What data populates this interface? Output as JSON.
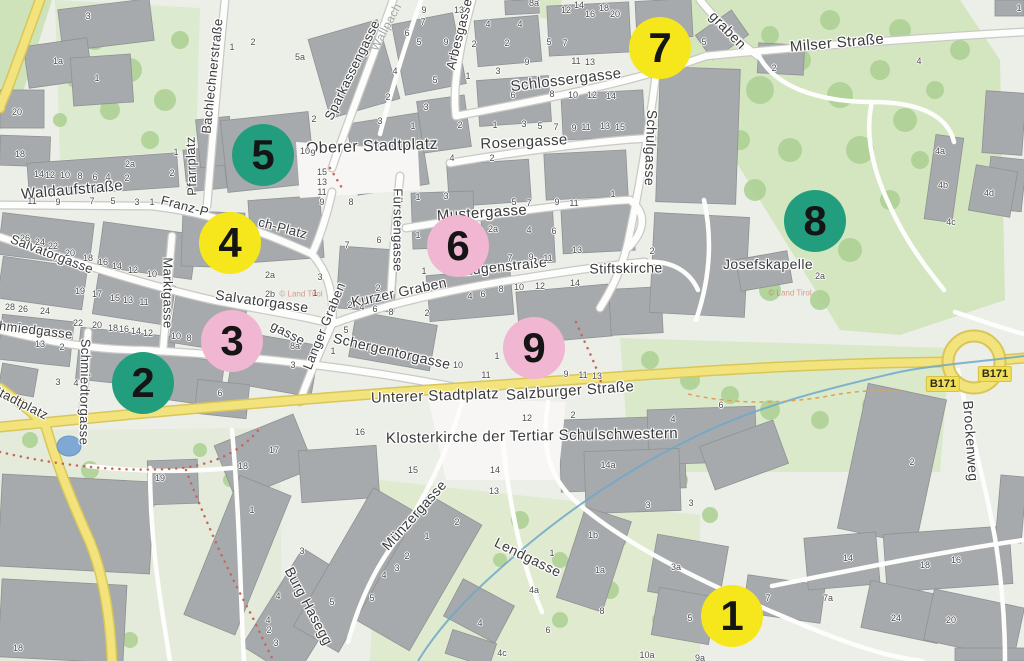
{
  "map": {
    "colors": {
      "marker_yellow": "#f6e71d",
      "marker_teal": "#229e7f",
      "marker_pink": "#f1b6d1",
      "road_yellow": "#f3e37c",
      "road_casing": "#d9c65a",
      "water": "#6fa8c9",
      "green": "#d3e6c0",
      "tree": "#aed295",
      "building": "#a7aaac"
    },
    "markers": [
      {
        "n": "1",
        "c": "yellow",
        "x": 732,
        "y": 616
      },
      {
        "n": "2",
        "c": "teal",
        "x": 143,
        "y": 383
      },
      {
        "n": "3",
        "c": "pink",
        "x": 232,
        "y": 341
      },
      {
        "n": "4",
        "c": "yellow",
        "x": 230,
        "y": 243
      },
      {
        "n": "5",
        "c": "teal",
        "x": 263,
        "y": 155
      },
      {
        "n": "6",
        "c": "pink",
        "x": 458,
        "y": 246
      },
      {
        "n": "7",
        "c": "yellow",
        "x": 660,
        "y": 48
      },
      {
        "n": "8",
        "c": "teal",
        "x": 815,
        "y": 221
      },
      {
        "n": "9",
        "c": "pink",
        "x": 534,
        "y": 348
      }
    ],
    "street_labels": [
      {
        "t": "Waldaufstraße",
        "x": 72,
        "y": 190,
        "r": -5,
        "s": 15
      },
      {
        "t": "Franz-P",
        "x": 185,
        "y": 206,
        "r": 15,
        "s": 13
      },
      {
        "t": "ch-Platz",
        "x": 283,
        "y": 228,
        "r": 15,
        "s": 13
      },
      {
        "t": "Pfarrplatz",
        "x": 191,
        "y": 166,
        "r": -92,
        "s": 13
      },
      {
        "t": "Bachlechnerstraße",
        "x": 212,
        "y": 76,
        "r": -84,
        "s": 13
      },
      {
        "t": "Sparkassengasse",
        "x": 352,
        "y": 70,
        "r": -64,
        "s": 13
      },
      {
        "t": "Wallpach",
        "x": 386,
        "y": 27,
        "r": -62,
        "s": 12,
        "c": "faint"
      },
      {
        "t": "Arbesgasse",
        "x": 459,
        "y": 34,
        "r": -76,
        "s": 13
      },
      {
        "t": "Schlossergasse",
        "x": 566,
        "y": 80,
        "r": -7,
        "s": 15
      },
      {
        "t": "Milser Straße",
        "x": 837,
        "y": 43,
        "r": -5,
        "s": 15
      },
      {
        "t": "graben",
        "x": 728,
        "y": 30,
        "r": 46,
        "s": 14
      },
      {
        "t": "Oberer Stadtplatz",
        "x": 372,
        "y": 147,
        "r": -2,
        "s": 16
      },
      {
        "t": "Rosengasse",
        "x": 524,
        "y": 142,
        "r": -3,
        "s": 15
      },
      {
        "t": "Mustergasse",
        "x": 482,
        "y": 213,
        "r": -4,
        "s": 15
      },
      {
        "t": "Fürstengasse",
        "x": 398,
        "y": 230,
        "r": 90,
        "s": 13
      },
      {
        "t": "Schulgasse",
        "x": 651,
        "y": 148,
        "r": 92,
        "s": 14
      },
      {
        "t": "Salvatorgasse",
        "x": 52,
        "y": 254,
        "r": 21,
        "s": 13
      },
      {
        "t": "Salvatorgasse",
        "x": 262,
        "y": 301,
        "r": 8,
        "s": 14
      },
      {
        "t": "gasse",
        "x": 288,
        "y": 333,
        "r": 28,
        "s": 13
      },
      {
        "t": "Schmiedgasse",
        "x": 28,
        "y": 329,
        "r": 7,
        "s": 13
      },
      {
        "t": "Stadtplatz",
        "x": 20,
        "y": 402,
        "r": 27,
        "s": 13
      },
      {
        "t": "Schmiedtorgasse",
        "x": 85,
        "y": 392,
        "r": 91,
        "s": 13
      },
      {
        "t": "Marktgasse",
        "x": 168,
        "y": 293,
        "r": 90,
        "s": 13
      },
      {
        "t": "Langer Graben",
        "x": 324,
        "y": 326,
        "r": -68,
        "s": 13
      },
      {
        "t": "Kurzer Graben",
        "x": 399,
        "y": 292,
        "r": -12,
        "s": 14
      },
      {
        "t": "Eugenstraße",
        "x": 505,
        "y": 266,
        "r": -6,
        "s": 14
      },
      {
        "t": "Stiftskirche",
        "x": 626,
        "y": 268,
        "r": -1,
        "s": 14
      },
      {
        "t": "Schergentorgasse",
        "x": 392,
        "y": 351,
        "r": 13,
        "s": 14
      },
      {
        "t": "Unterer Stadtplatz",
        "x": 435,
        "y": 396,
        "r": -2,
        "s": 15
      },
      {
        "t": "Salzburger Straße",
        "x": 570,
        "y": 391,
        "r": -4,
        "s": 15
      },
      {
        "t": "Klosterkirche der Tertiar Schulschwestern",
        "x": 532,
        "y": 436,
        "r": -1,
        "s": 15
      },
      {
        "t": "Münzergasse",
        "x": 414,
        "y": 515,
        "r": -48,
        "s": 14
      },
      {
        "t": "Lendgasse",
        "x": 528,
        "y": 557,
        "r": 26,
        "s": 14
      },
      {
        "t": "Burg Hasegg",
        "x": 309,
        "y": 606,
        "r": 62,
        "s": 14
      },
      {
        "t": "Josefskapelle",
        "x": 768,
        "y": 264,
        "r": 0,
        "s": 14
      },
      {
        "t": "Brockenweg",
        "x": 971,
        "y": 441,
        "r": 86,
        "s": 14
      }
    ],
    "route_badges": [
      {
        "t": "B171",
        "x": 943,
        "y": 384
      },
      {
        "t": "B171",
        "x": 995,
        "y": 374
      }
    ],
    "watermarks": [
      {
        "t": "© Land Tirol",
        "x": 301,
        "y": 294
      },
      {
        "t": "© Land Tirol",
        "x": 790,
        "y": 293
      }
    ],
    "house_numbers": [
      [
        88,
        16,
        "3"
      ],
      [
        58,
        61,
        "1a"
      ],
      [
        97,
        78,
        "1"
      ],
      [
        17,
        112,
        "20"
      ],
      [
        20,
        154,
        "18"
      ],
      [
        130,
        164,
        "2a"
      ],
      [
        176,
        152,
        "1"
      ],
      [
        172,
        173,
        "2"
      ],
      [
        39,
        174,
        "14"
      ],
      [
        50,
        175,
        "12"
      ],
      [
        65,
        175,
        "10"
      ],
      [
        80,
        176,
        "8"
      ],
      [
        95,
        177,
        "6"
      ],
      [
        108,
        177,
        "4"
      ],
      [
        127,
        178,
        "2"
      ],
      [
        32,
        201,
        "11"
      ],
      [
        58,
        202,
        "9"
      ],
      [
        92,
        201,
        "7"
      ],
      [
        113,
        201,
        "5"
      ],
      [
        137,
        202,
        "3"
      ],
      [
        152,
        202,
        "1"
      ],
      [
        25,
        238,
        "26"
      ],
      [
        40,
        242,
        "24"
      ],
      [
        53,
        246,
        "22"
      ],
      [
        70,
        253,
        "20"
      ],
      [
        88,
        258,
        "18"
      ],
      [
        103,
        262,
        "16"
      ],
      [
        117,
        266,
        "14"
      ],
      [
        133,
        270,
        "12"
      ],
      [
        152,
        274,
        "10"
      ],
      [
        80,
        291,
        "19"
      ],
      [
        97,
        294,
        "17"
      ],
      [
        115,
        298,
        "15"
      ],
      [
        128,
        300,
        "13"
      ],
      [
        144,
        302,
        "11"
      ],
      [
        10,
        307,
        "28"
      ],
      [
        23,
        309,
        "26"
      ],
      [
        45,
        311,
        "24"
      ],
      [
        78,
        323,
        "22"
      ],
      [
        97,
        325,
        "20"
      ],
      [
        113,
        328,
        "18"
      ],
      [
        124,
        329,
        "16"
      ],
      [
        136,
        331,
        "14"
      ],
      [
        148,
        333,
        "12"
      ],
      [
        40,
        344,
        "13"
      ],
      [
        62,
        347,
        "2"
      ],
      [
        176,
        336,
        "10"
      ],
      [
        189,
        338,
        "8"
      ],
      [
        58,
        382,
        "3"
      ],
      [
        76,
        383,
        "4"
      ],
      [
        220,
        393,
        "6"
      ],
      [
        232,
        47,
        "1"
      ],
      [
        253,
        42,
        "2"
      ],
      [
        300,
        57,
        "5a"
      ],
      [
        305,
        151,
        "10"
      ],
      [
        313,
        153,
        "9"
      ],
      [
        322,
        172,
        "15"
      ],
      [
        322,
        182,
        "13"
      ],
      [
        322,
        192,
        "11"
      ],
      [
        322,
        202,
        "9"
      ],
      [
        424,
        10,
        "9"
      ],
      [
        423,
        22,
        "7"
      ],
      [
        419,
        42,
        "5"
      ],
      [
        407,
        33,
        "6"
      ],
      [
        395,
        71,
        "4"
      ],
      [
        435,
        80,
        "5"
      ],
      [
        388,
        97,
        "2"
      ],
      [
        426,
        107,
        "3"
      ],
      [
        380,
        121,
        "3"
      ],
      [
        413,
        126,
        "1"
      ],
      [
        314,
        119,
        "2"
      ],
      [
        459,
        10,
        "13"
      ],
      [
        446,
        42,
        "9"
      ],
      [
        474,
        44,
        "2"
      ],
      [
        488,
        24,
        "4"
      ],
      [
        507,
        43,
        "2"
      ],
      [
        520,
        24,
        "4"
      ],
      [
        468,
        76,
        "1"
      ],
      [
        498,
        71,
        "3"
      ],
      [
        534,
        3,
        "8a"
      ],
      [
        566,
        10,
        "12"
      ],
      [
        579,
        5,
        "14"
      ],
      [
        590,
        14,
        "16"
      ],
      [
        604,
        8,
        "18"
      ],
      [
        615,
        14,
        "20"
      ],
      [
        549,
        42,
        "5"
      ],
      [
        565,
        43,
        "7"
      ],
      [
        527,
        62,
        "9"
      ],
      [
        576,
        61,
        "11"
      ],
      [
        590,
        62,
        "13"
      ],
      [
        460,
        125,
        "2"
      ],
      [
        495,
        125,
        "1"
      ],
      [
        524,
        124,
        "3"
      ],
      [
        540,
        126,
        "5"
      ],
      [
        556,
        127,
        "7"
      ],
      [
        574,
        128,
        "9"
      ],
      [
        586,
        127,
        "11"
      ],
      [
        605,
        126,
        "13"
      ],
      [
        620,
        127,
        "15"
      ],
      [
        452,
        158,
        "4"
      ],
      [
        492,
        158,
        "2"
      ],
      [
        513,
        95,
        "6"
      ],
      [
        552,
        94,
        "8"
      ],
      [
        573,
        95,
        "10"
      ],
      [
        592,
        95,
        "12"
      ],
      [
        611,
        96,
        "14"
      ],
      [
        351,
        202,
        "8"
      ],
      [
        418,
        197,
        "1"
      ],
      [
        446,
        196,
        "3"
      ],
      [
        514,
        202,
        "5"
      ],
      [
        529,
        203,
        "7"
      ],
      [
        557,
        202,
        "9"
      ],
      [
        574,
        203,
        "11"
      ],
      [
        613,
        194,
        "1"
      ],
      [
        347,
        245,
        "7"
      ],
      [
        379,
        240,
        "6"
      ],
      [
        418,
        235,
        "1"
      ],
      [
        493,
        229,
        "2a"
      ],
      [
        529,
        230,
        "4"
      ],
      [
        554,
        231,
        "6"
      ],
      [
        577,
        250,
        "13"
      ],
      [
        424,
        271,
        "1"
      ],
      [
        510,
        258,
        "7"
      ],
      [
        531,
        257,
        "9"
      ],
      [
        548,
        258,
        "11"
      ],
      [
        652,
        251,
        "2"
      ],
      [
        470,
        296,
        "4"
      ],
      [
        483,
        294,
        "6"
      ],
      [
        501,
        289,
        "8"
      ],
      [
        519,
        287,
        "10"
      ],
      [
        540,
        286,
        "12"
      ],
      [
        575,
        283,
        "14"
      ],
      [
        270,
        275,
        "2a"
      ],
      [
        320,
        277,
        "3"
      ],
      [
        270,
        294,
        "2b"
      ],
      [
        315,
        293,
        "1"
      ],
      [
        378,
        288,
        "2"
      ],
      [
        350,
        305,
        "2"
      ],
      [
        362,
        307,
        "4"
      ],
      [
        375,
        309,
        "6"
      ],
      [
        391,
        312,
        "8"
      ],
      [
        427,
        313,
        "2"
      ],
      [
        346,
        330,
        "5"
      ],
      [
        333,
        351,
        "1"
      ],
      [
        295,
        346,
        "8a"
      ],
      [
        293,
        365,
        "3"
      ],
      [
        458,
        365,
        "10"
      ],
      [
        486,
        375,
        "11"
      ],
      [
        497,
        356,
        "1"
      ],
      [
        566,
        374,
        "9"
      ],
      [
        583,
        375,
        "11"
      ],
      [
        597,
        376,
        "13"
      ],
      [
        527,
        418,
        "12"
      ],
      [
        573,
        415,
        "2"
      ],
      [
        673,
        419,
        "4"
      ],
      [
        360,
        432,
        "16"
      ],
      [
        704,
        42,
        "5"
      ],
      [
        774,
        68,
        "2"
      ],
      [
        919,
        61,
        "4"
      ],
      [
        1019,
        8,
        "1"
      ],
      [
        940,
        151,
        "4a"
      ],
      [
        943,
        185,
        "4b"
      ],
      [
        951,
        222,
        "4c"
      ],
      [
        989,
        193,
        "4d"
      ],
      [
        820,
        276,
        "2a"
      ],
      [
        721,
        405,
        "6"
      ],
      [
        912,
        462,
        "2"
      ],
      [
        648,
        505,
        "3"
      ],
      [
        413,
        470,
        "15"
      ],
      [
        495,
        470,
        "14"
      ],
      [
        494,
        491,
        "13"
      ],
      [
        608,
        465,
        "14a"
      ],
      [
        593,
        535,
        "1b"
      ],
      [
        600,
        570,
        "1a"
      ],
      [
        691,
        503,
        "3"
      ],
      [
        457,
        522,
        "2"
      ],
      [
        427,
        536,
        "1"
      ],
      [
        407,
        556,
        "2"
      ],
      [
        397,
        568,
        "3"
      ],
      [
        384,
        575,
        "4"
      ],
      [
        372,
        598,
        "5"
      ],
      [
        332,
        602,
        "5"
      ],
      [
        302,
        551,
        "3"
      ],
      [
        552,
        553,
        "1"
      ],
      [
        534,
        590,
        "4a"
      ],
      [
        602,
        611,
        "8"
      ],
      [
        548,
        630,
        "6"
      ],
      [
        480,
        623,
        "4"
      ],
      [
        502,
        653,
        "4c"
      ],
      [
        647,
        655,
        "10a"
      ],
      [
        700,
        658,
        "9a"
      ],
      [
        676,
        567,
        "3a"
      ],
      [
        690,
        618,
        "5"
      ],
      [
        768,
        598,
        "7"
      ],
      [
        828,
        598,
        "7a"
      ],
      [
        848,
        558,
        "14"
      ],
      [
        925,
        565,
        "18"
      ],
      [
        956,
        560,
        "16"
      ],
      [
        896,
        618,
        "24"
      ],
      [
        951,
        620,
        "20"
      ],
      [
        18,
        648,
        "18"
      ],
      [
        160,
        478,
        "19"
      ],
      [
        274,
        450,
        "17"
      ],
      [
        243,
        466,
        "18"
      ],
      [
        252,
        510,
        "1"
      ],
      [
        269,
        630,
        "2"
      ],
      [
        278,
        596,
        "4"
      ],
      [
        268,
        620,
        "4"
      ],
      [
        276,
        643,
        "3"
      ]
    ]
  }
}
